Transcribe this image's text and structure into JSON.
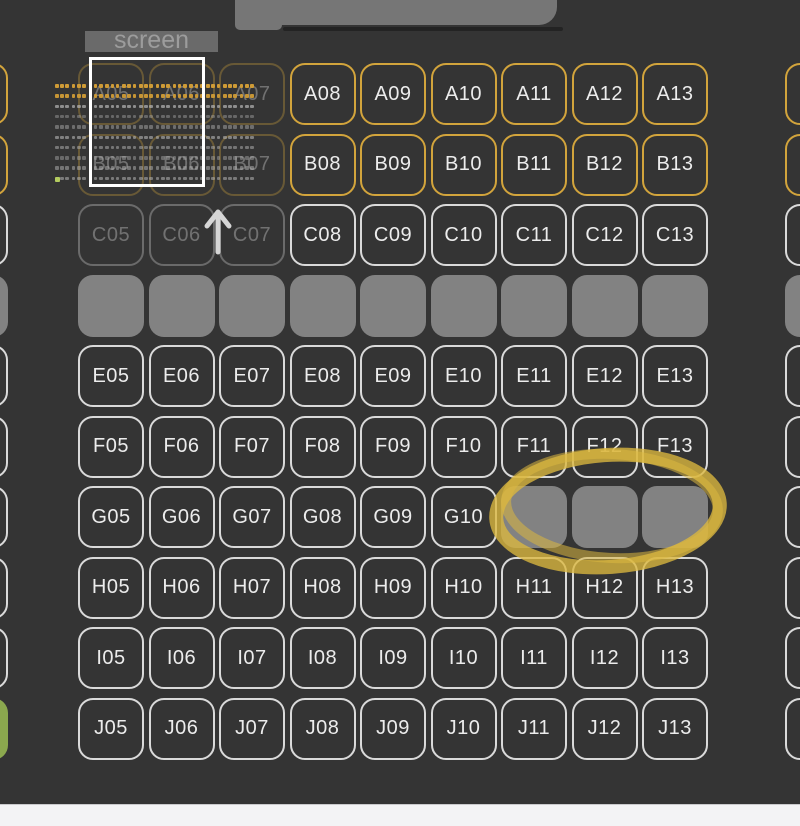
{
  "screen": {
    "label": "screen"
  },
  "colors": {
    "bg": "#343434",
    "seat_outline": "#dadada",
    "seat_outline_vip": "#d2a43c",
    "seat_sold": "#828282",
    "seat_selected": "#8ba84e",
    "seat_label": "#ececec",
    "screen_bar": "#6a6a6a",
    "screen_text": "#9c9c9c",
    "viewport": "#ffffff",
    "annotation": "#dcb83f",
    "top_tab": "#767676",
    "bottom_bar": "#f3f3f5",
    "arrow": "#d6d6d6",
    "minimap_vip": "#cf9b36",
    "minimap_seat": "#b5b5b5",
    "minimap_selected": "#b3cb5f"
  },
  "annotations": {
    "circled_seats": [
      "G11",
      "G12",
      "G13"
    ]
  },
  "minimap": {
    "rows": 10,
    "groups_per_row": 12,
    "dots_per_group": 3,
    "row_colors": [
      "#cf9b36",
      "#cf9b36",
      "#b5b5b5",
      "#b5b5b5",
      "#b5b5b5",
      "#b5b5b5",
      "#b5b5b5",
      "#b5b5b5",
      "#b5b5b5",
      "#b5b5b5"
    ],
    "row_opacities": [
      1,
      0.95,
      0.7,
      0.4,
      0.45,
      0.6,
      0.5,
      0.42,
      0.5,
      0.55
    ],
    "green_dot": {
      "row": 9,
      "group": 0,
      "dot": 0
    },
    "green_color": "#b3cb5f"
  },
  "seat_map": {
    "rows": [
      {
        "letter": "A",
        "seats": [
          {
            "col": 4,
            "state": "vip",
            "partial": true
          },
          {
            "col": 5,
            "state": "vip",
            "label": "A05",
            "faded": true
          },
          {
            "col": 6,
            "state": "vip",
            "label": "A06",
            "faded": true
          },
          {
            "col": 7,
            "state": "vip",
            "label": "A07",
            "faded": true
          },
          {
            "col": 8,
            "state": "vip",
            "label": "A08"
          },
          {
            "col": 9,
            "state": "vip",
            "label": "A09"
          },
          {
            "col": 10,
            "state": "vip",
            "label": "A10"
          },
          {
            "col": 11,
            "state": "vip",
            "label": "A11"
          },
          {
            "col": 12,
            "state": "vip",
            "label": "A12"
          },
          {
            "col": 13,
            "state": "vip",
            "label": "A13"
          },
          {
            "col": 14,
            "state": "vip",
            "partial": true
          }
        ]
      },
      {
        "letter": "B",
        "seats": [
          {
            "col": 4,
            "state": "vip",
            "partial": true
          },
          {
            "col": 5,
            "state": "vip",
            "label": "B05",
            "faded": true
          },
          {
            "col": 6,
            "state": "vip",
            "label": "B06",
            "faded": true
          },
          {
            "col": 7,
            "state": "vip",
            "label": "B07",
            "faded": true
          },
          {
            "col": 8,
            "state": "vip",
            "label": "B08"
          },
          {
            "col": 9,
            "state": "vip",
            "label": "B09"
          },
          {
            "col": 10,
            "state": "vip",
            "label": "B10"
          },
          {
            "col": 11,
            "state": "vip",
            "label": "B11"
          },
          {
            "col": 12,
            "state": "vip",
            "label": "B12"
          },
          {
            "col": 13,
            "state": "vip",
            "label": "B13"
          },
          {
            "col": 14,
            "state": "vip",
            "partial": true
          }
        ]
      },
      {
        "letter": "C",
        "seats": [
          {
            "col": 4,
            "state": "standard",
            "partial": true
          },
          {
            "col": 5,
            "state": "standard",
            "label": "C05",
            "faded": true
          },
          {
            "col": 6,
            "state": "standard",
            "label": "C06",
            "faded": true
          },
          {
            "col": 7,
            "state": "standard",
            "label": "C07",
            "faded": true
          },
          {
            "col": 8,
            "state": "standard",
            "label": "C08"
          },
          {
            "col": 9,
            "state": "standard",
            "label": "C09"
          },
          {
            "col": 10,
            "state": "standard",
            "label": "C10"
          },
          {
            "col": 11,
            "state": "standard",
            "label": "C11"
          },
          {
            "col": 12,
            "state": "standard",
            "label": "C12"
          },
          {
            "col": 13,
            "state": "standard",
            "label": "C13"
          },
          {
            "col": 14,
            "state": "standard",
            "partial": true
          }
        ]
      },
      {
        "letter": "D",
        "seats": [
          {
            "col": 4,
            "state": "sold",
            "partial": true
          },
          {
            "col": 5,
            "state": "sold"
          },
          {
            "col": 6,
            "state": "sold"
          },
          {
            "col": 7,
            "state": "sold"
          },
          {
            "col": 8,
            "state": "sold"
          },
          {
            "col": 9,
            "state": "sold"
          },
          {
            "col": 10,
            "state": "sold"
          },
          {
            "col": 11,
            "state": "sold"
          },
          {
            "col": 12,
            "state": "sold"
          },
          {
            "col": 13,
            "state": "sold"
          },
          {
            "col": 14,
            "state": "sold",
            "partial": true
          }
        ]
      },
      {
        "letter": "E",
        "seats": [
          {
            "col": 4,
            "state": "standard",
            "partial": true
          },
          {
            "col": 5,
            "state": "standard",
            "label": "E05"
          },
          {
            "col": 6,
            "state": "standard",
            "label": "E06"
          },
          {
            "col": 7,
            "state": "standard",
            "label": "E07"
          },
          {
            "col": 8,
            "state": "standard",
            "label": "E08"
          },
          {
            "col": 9,
            "state": "standard",
            "label": "E09"
          },
          {
            "col": 10,
            "state": "standard",
            "label": "E10"
          },
          {
            "col": 11,
            "state": "standard",
            "label": "E11"
          },
          {
            "col": 12,
            "state": "standard",
            "label": "E12"
          },
          {
            "col": 13,
            "state": "standard",
            "label": "E13"
          },
          {
            "col": 14,
            "state": "standard",
            "partial": true
          }
        ]
      },
      {
        "letter": "F",
        "seats": [
          {
            "col": 4,
            "state": "standard",
            "partial": true
          },
          {
            "col": 5,
            "state": "standard",
            "label": "F05"
          },
          {
            "col": 6,
            "state": "standard",
            "label": "F06"
          },
          {
            "col": 7,
            "state": "standard",
            "label": "F07"
          },
          {
            "col": 8,
            "state": "standard",
            "label": "F08"
          },
          {
            "col": 9,
            "state": "standard",
            "label": "F09"
          },
          {
            "col": 10,
            "state": "standard",
            "label": "F10"
          },
          {
            "col": 11,
            "state": "standard",
            "label": "F11"
          },
          {
            "col": 12,
            "state": "standard",
            "label": "F12"
          },
          {
            "col": 13,
            "state": "standard",
            "label": "F13"
          },
          {
            "col": 14,
            "state": "standard",
            "partial": true
          }
        ]
      },
      {
        "letter": "G",
        "seats": [
          {
            "col": 4,
            "state": "standard",
            "partial": true
          },
          {
            "col": 5,
            "state": "standard",
            "label": "G05"
          },
          {
            "col": 6,
            "state": "standard",
            "label": "G06"
          },
          {
            "col": 7,
            "state": "standard",
            "label": "G07"
          },
          {
            "col": 8,
            "state": "standard",
            "label": "G08"
          },
          {
            "col": 9,
            "state": "standard",
            "label": "G09"
          },
          {
            "col": 10,
            "state": "standard",
            "label": "G10"
          },
          {
            "col": 11,
            "state": "sold"
          },
          {
            "col": 12,
            "state": "sold"
          },
          {
            "col": 13,
            "state": "sold"
          },
          {
            "col": 14,
            "state": "standard",
            "partial": true
          }
        ]
      },
      {
        "letter": "H",
        "seats": [
          {
            "col": 4,
            "state": "standard",
            "partial": true
          },
          {
            "col": 5,
            "state": "standard",
            "label": "H05"
          },
          {
            "col": 6,
            "state": "standard",
            "label": "H06"
          },
          {
            "col": 7,
            "state": "standard",
            "label": "H07"
          },
          {
            "col": 8,
            "state": "standard",
            "label": "H08"
          },
          {
            "col": 9,
            "state": "standard",
            "label": "H09"
          },
          {
            "col": 10,
            "state": "standard",
            "label": "H10"
          },
          {
            "col": 11,
            "state": "standard",
            "label": "H11"
          },
          {
            "col": 12,
            "state": "standard",
            "label": "H12"
          },
          {
            "col": 13,
            "state": "standard",
            "label": "H13"
          },
          {
            "col": 14,
            "state": "standard",
            "partial": true
          }
        ]
      },
      {
        "letter": "I",
        "seats": [
          {
            "col": 4,
            "state": "standard",
            "partial": true
          },
          {
            "col": 5,
            "state": "standard",
            "label": "I05"
          },
          {
            "col": 6,
            "state": "standard",
            "label": "I06"
          },
          {
            "col": 7,
            "state": "standard",
            "label": "I07"
          },
          {
            "col": 8,
            "state": "standard",
            "label": "I08"
          },
          {
            "col": 9,
            "state": "standard",
            "label": "I09"
          },
          {
            "col": 10,
            "state": "standard",
            "label": "I10"
          },
          {
            "col": 11,
            "state": "standard",
            "label": "I11"
          },
          {
            "col": 12,
            "state": "standard",
            "label": "I12"
          },
          {
            "col": 13,
            "state": "standard",
            "label": "I13"
          },
          {
            "col": 14,
            "state": "standard",
            "partial": true
          }
        ]
      },
      {
        "letter": "J",
        "seats": [
          {
            "col": 4,
            "state": "selected",
            "partial": true
          },
          {
            "col": 5,
            "state": "standard",
            "label": "J05"
          },
          {
            "col": 6,
            "state": "standard",
            "label": "J06"
          },
          {
            "col": 7,
            "state": "standard",
            "label": "J07"
          },
          {
            "col": 8,
            "state": "standard",
            "label": "J08"
          },
          {
            "col": 9,
            "state": "standard",
            "label": "J09"
          },
          {
            "col": 10,
            "state": "standard",
            "label": "J10"
          },
          {
            "col": 11,
            "state": "standard",
            "label": "J11"
          },
          {
            "col": 12,
            "state": "standard",
            "label": "J12"
          },
          {
            "col": 13,
            "state": "standard",
            "label": "J13"
          },
          {
            "col": 14,
            "state": "standard",
            "partial": true
          }
        ]
      }
    ]
  }
}
